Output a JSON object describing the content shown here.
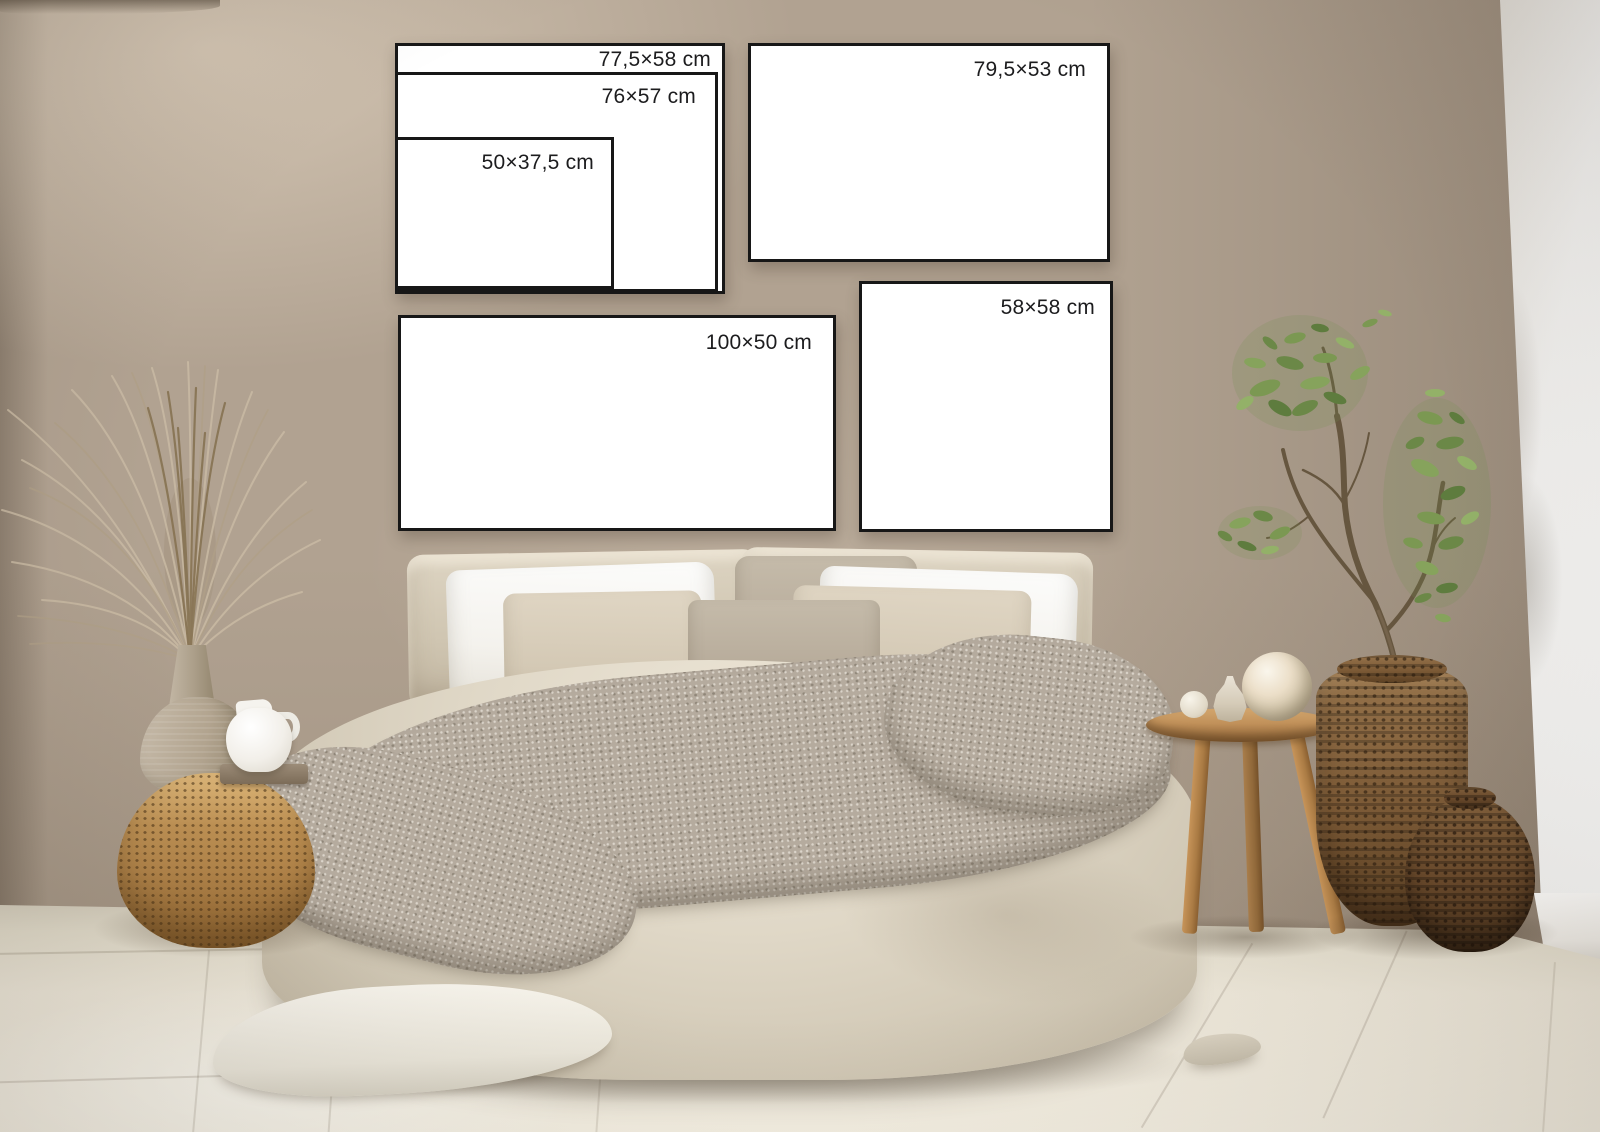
{
  "frames": [
    {
      "name": "nested-outer",
      "label": "77,5×58 cm"
    },
    {
      "name": "nested-middle",
      "label": "76×57 cm"
    },
    {
      "name": "nested-inner",
      "label": "50×37,5 cm"
    },
    {
      "name": "top-right",
      "label": "79,5×53 cm"
    },
    {
      "name": "mid-right-square",
      "label": "58×58 cm"
    },
    {
      "name": "bottom-left-wide",
      "label": "100×50 cm"
    }
  ],
  "colors": {
    "frame_border": "#171717",
    "frame_fill": "#ffffff",
    "label_text": "#1c1c1e",
    "wall_beige": "#b1a291",
    "wall_light": "#c2b3a1",
    "white_wall": "#f3f2f0",
    "floor": "#efeadb",
    "duvet_linen": "#ddd5c3",
    "pillow_white": "#f8f7f4",
    "pillow_beige": "#d5cab6",
    "pillow_accent": "#bcb09f",
    "throw_gray": "#b5ab9e",
    "wicker_gold": "#bb8e51",
    "wicker_dark": "#6f5133",
    "wood": "#b9854d",
    "ceramic_taupe": "#b1a490",
    "jug_white": "#f2efe9",
    "plant_green": "#76924f",
    "pampas": "#c0b098"
  }
}
